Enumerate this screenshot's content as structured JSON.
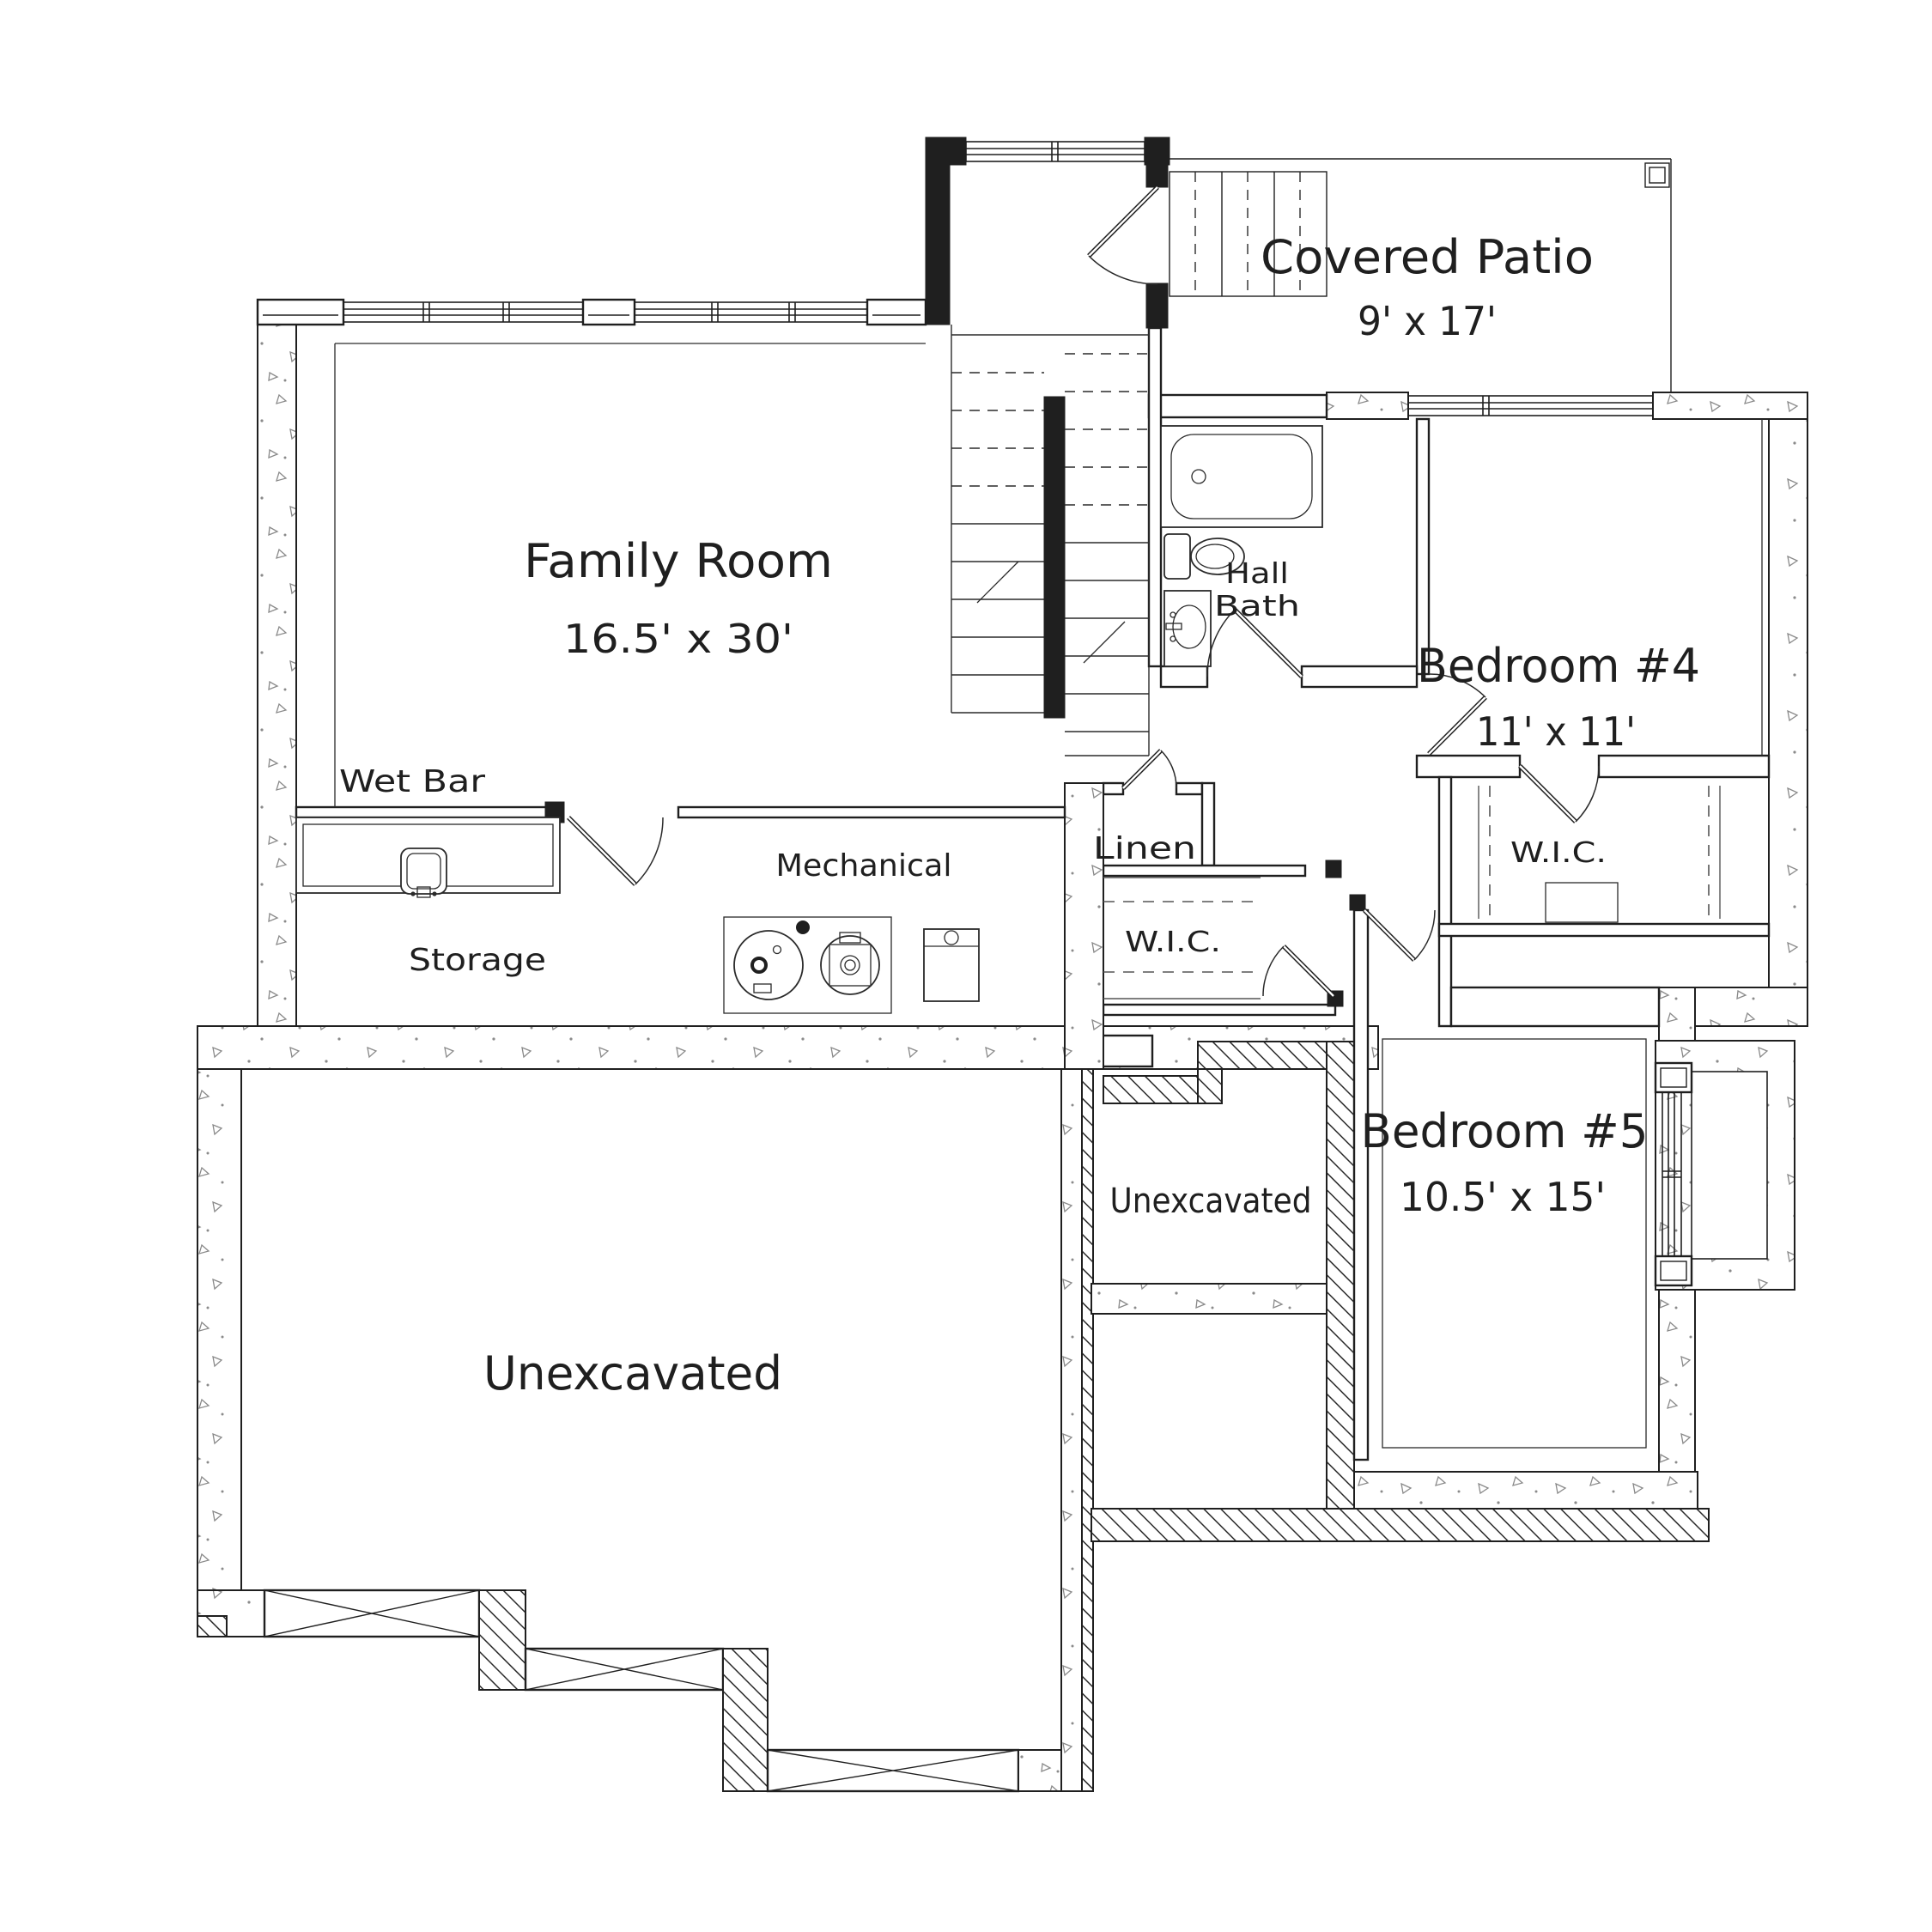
{
  "plan": {
    "type": "basement-floor-plan",
    "rooms": {
      "family_room": {
        "name": "Family Room",
        "dims": "16.5' x 30'"
      },
      "covered_patio": {
        "name": "Covered Patio",
        "dims": "9' x 17'"
      },
      "bedroom4": {
        "name": "Bedroom #4",
        "dims": "11' x 11'"
      },
      "hall_bath": {
        "line1": "Hall",
        "line2": "Bath"
      },
      "wet_bar": {
        "name": "Wet Bar"
      },
      "storage": {
        "name": "Storage"
      },
      "mechanical": {
        "name": "Mechanical"
      },
      "linen": {
        "name": "Linen"
      },
      "wic_hall": {
        "name": "W.I.C."
      },
      "wic_bedroom4": {
        "name": "W.I.C."
      },
      "bedroom5": {
        "name": "Bedroom #5",
        "dims": "10.5' x 15'"
      },
      "unexcavated_main": {
        "name": "Unexcavated"
      },
      "unexcavated_crawl": {
        "name": "Unexcavated"
      }
    },
    "fixtures": [
      "bathtub",
      "toilet",
      "vanity-sink",
      "wet-bar-sink",
      "furnace",
      "water-heater",
      "water-softener",
      "stairs",
      "egress-window-well"
    ],
    "colors": {
      "background": "#ffffff",
      "line": "#1f1f1f",
      "speckle": "#8a8a8a",
      "hatch": "#2a2a2a"
    }
  }
}
